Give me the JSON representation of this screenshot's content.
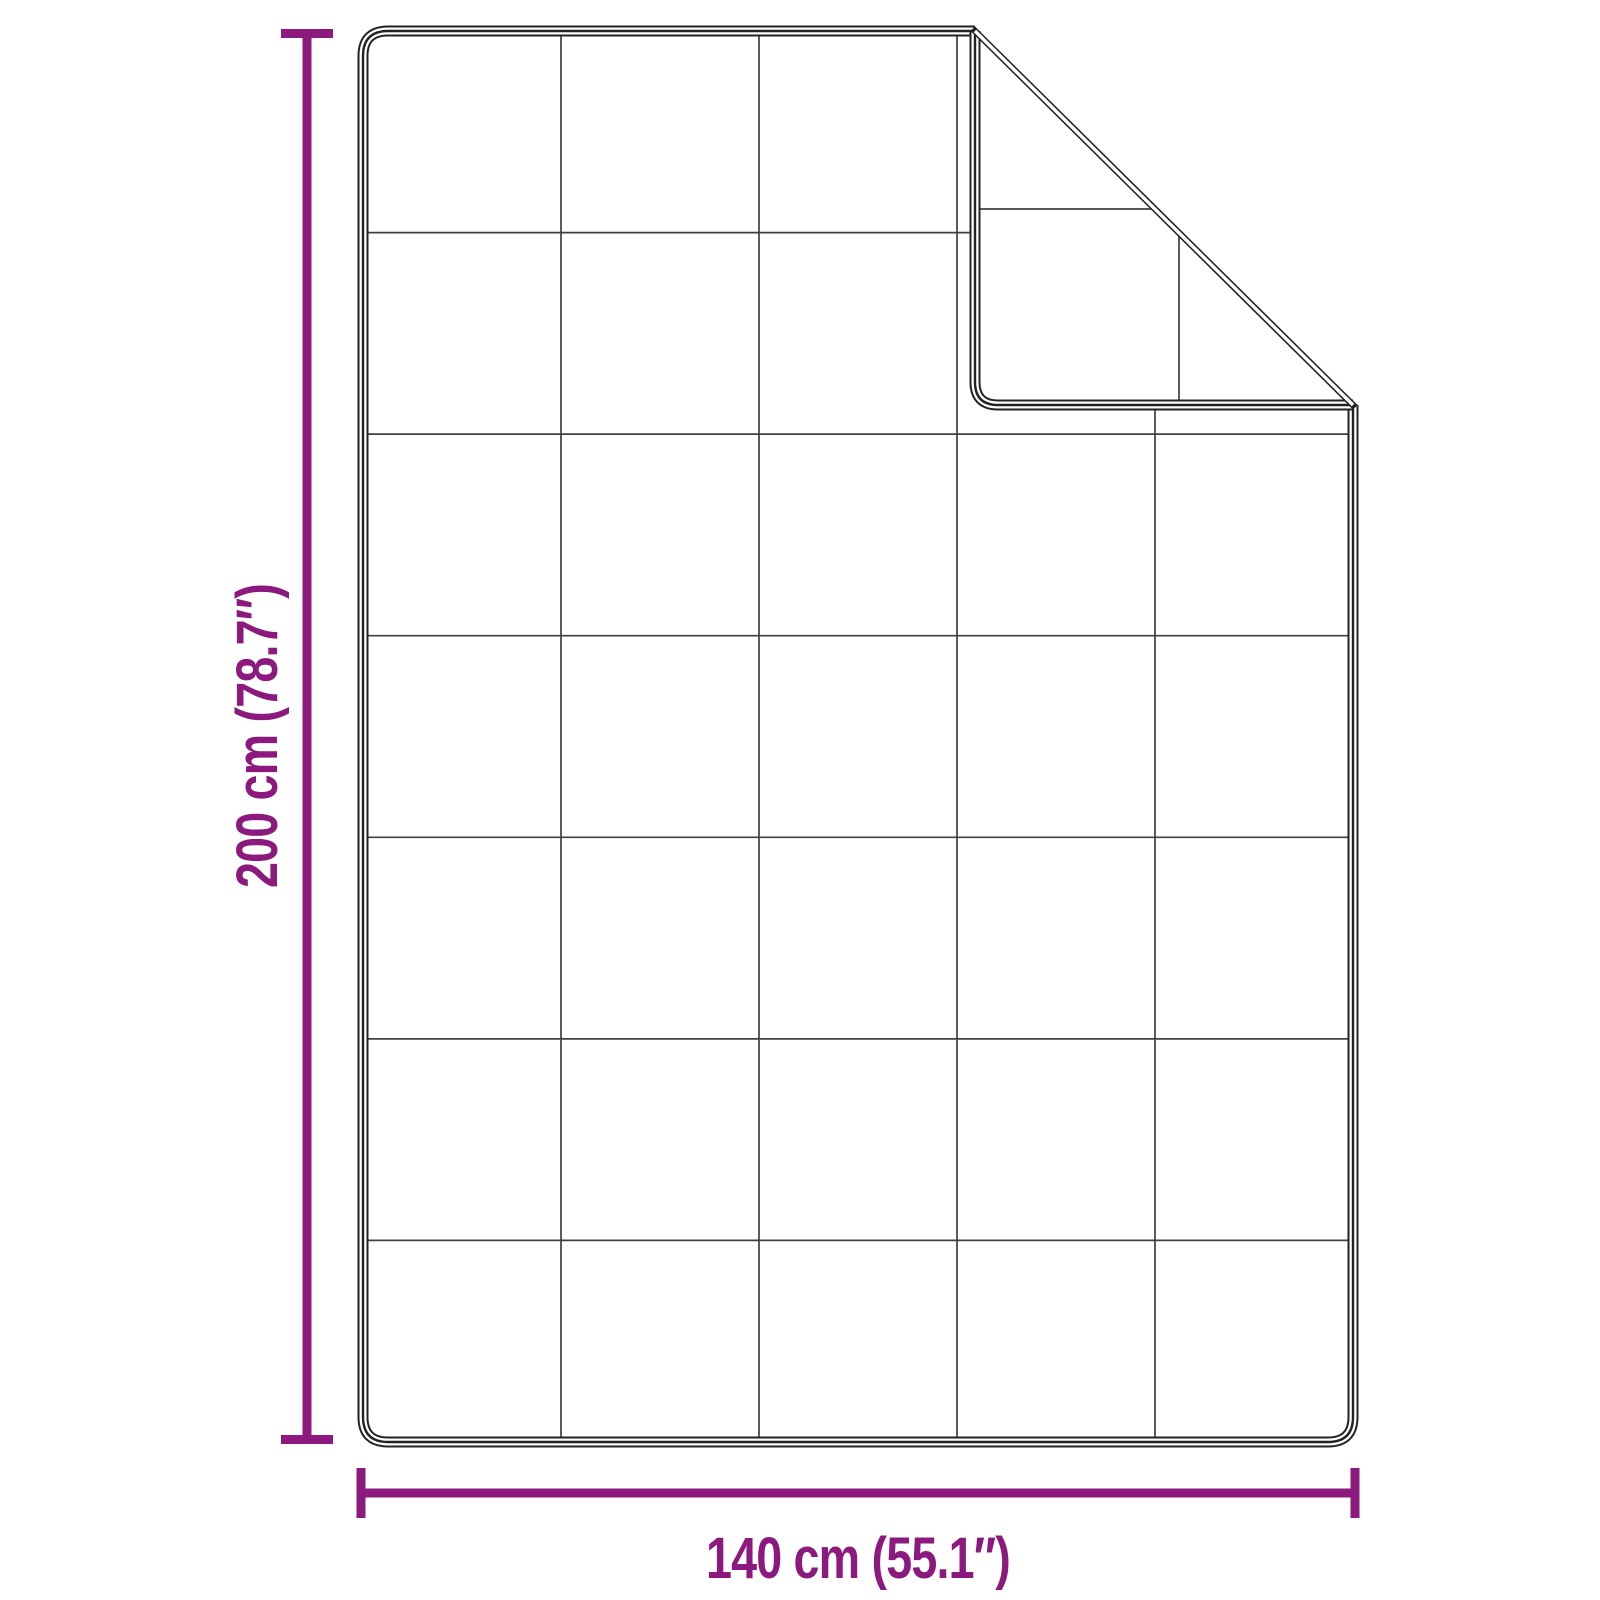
{
  "diagram": {
    "type": "product-dimension-diagram",
    "subject": "quilted weighted blanket with folded top-right corner",
    "labels": {
      "height": "200 cm (78.7″)",
      "width": "140 cm (55.1″)"
    },
    "values": {
      "height_cm": 200,
      "height_inches": 78.7,
      "width_cm": 140,
      "width_inches": 55.1
    },
    "grid": {
      "columns": 5,
      "rows": 7
    },
    "colors": {
      "accent": "#8C1A7E",
      "outline": "#222222",
      "grid_line": "#404040",
      "background": "#ffffff"
    }
  }
}
